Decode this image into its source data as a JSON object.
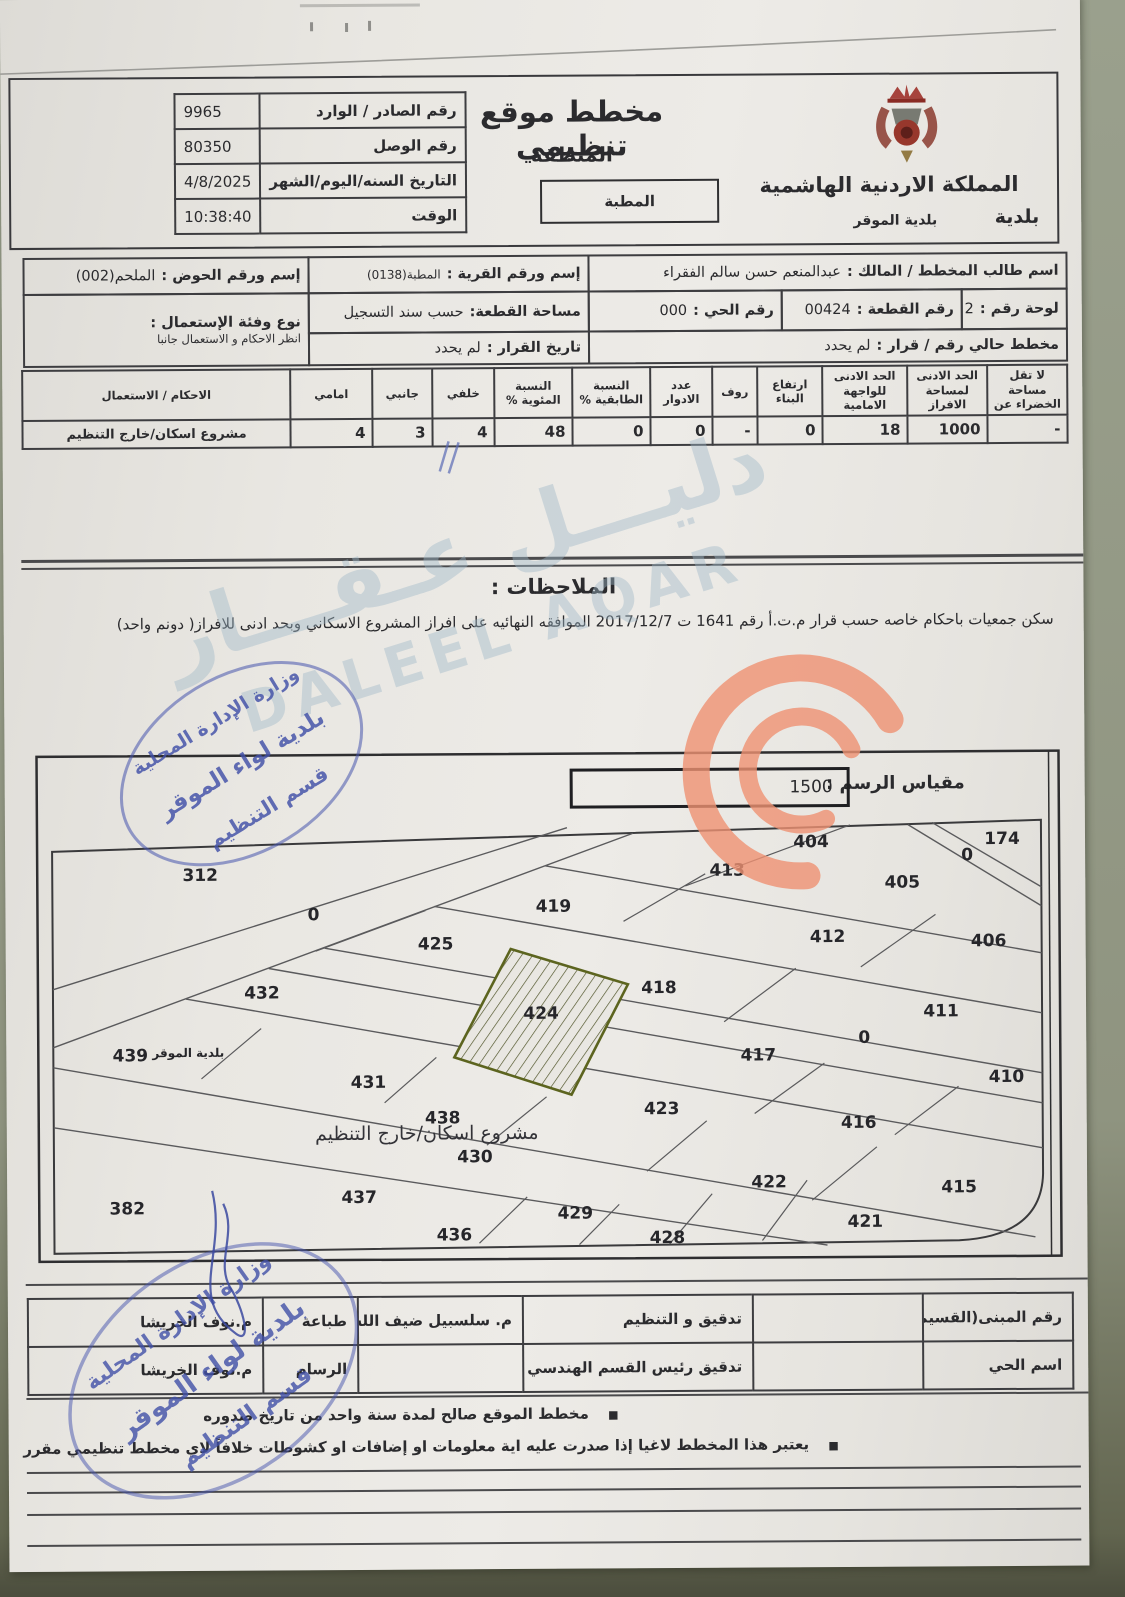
{
  "header": {
    "title": "مخطط موقع تنظيمي",
    "region_label": "المنطقة",
    "region_value": "المطبة",
    "kingdom": "المملكة الاردنية الهاشمية",
    "municipality_word": "بلدية",
    "municipality_name": "بلدية الموقر",
    "ref_rows": [
      {
        "label": "رقم الصادر / الوارد",
        "value": "9965"
      },
      {
        "label": "رقم الوصل",
        "value": "80350"
      },
      {
        "label": "التاريخ السنه/اليوم/الشهر",
        "value": "4/8/2025"
      },
      {
        "label": "الوقت",
        "value": "10:38:40"
      }
    ]
  },
  "info": {
    "owner_label": "اسم طالب المخطط / المالك :",
    "owner_value": "عبدالمنعم حسن سالم الفقراء",
    "village_label": "إسم ورقم القرية :",
    "village_value": "المطبة(0138)",
    "basin_label": "إسم ورقم الحوض :",
    "basin_value": "الملحم(002)",
    "sheet_label": "لوحة رقم :",
    "sheet_value": "2",
    "parcel_label": "رقم القطعة :",
    "parcel_value": "00424",
    "district_label": "رقم الحي :",
    "district_value": "000",
    "area_label": "مساحة القطعة:",
    "area_value": "حسب سند التسجيل",
    "use_label": "نوع وفئة الإستعمال :",
    "use_value": "انظر الاحكام و الاستعمال جانبا",
    "current_plan_label": "مخطط حالي رقم / قرار :",
    "current_plan_value": "لم يحدد",
    "decision_date_label": "تاريخ القرار :",
    "decision_date_value": "لم يحدد"
  },
  "setbacks": {
    "columns": [
      {
        "header": "لا تقل مساحة الخضراء عن",
        "value": "-"
      },
      {
        "header": "الحد الادنى لمساحة الافراز",
        "value": "1000"
      },
      {
        "header": "الحد الادنى للواجهة الامامية",
        "value": "18"
      },
      {
        "header": "ارتفاع البناء",
        "value": "0"
      },
      {
        "header": "روف",
        "value": "-"
      },
      {
        "header": "عدد الادوار",
        "value": "0"
      },
      {
        "header": "النسبة الطابقية %",
        "value": "0"
      },
      {
        "header": "النسبة المئوية %",
        "value": "48"
      },
      {
        "header": "خلفي",
        "value": "4"
      },
      {
        "header": "جانبي",
        "value": "3"
      },
      {
        "header": "امامي",
        "value": "4"
      },
      {
        "header": "الاحكام / الاستعمال",
        "value": "مشروع اسكان/خارج التنظيم"
      }
    ]
  },
  "notes": {
    "heading": "الملاحظات :",
    "text": "سكن جمعيات باحكام خاصه حسب قرار م.ت.أ رقم 1641 ت 2017/12/7 الموافقه النهائيه على افراز المشروع الاسكاني وبحد ادنى للافراز( دونم واحد)"
  },
  "map": {
    "scale_label": "مقياس الرسم :",
    "scale_value": "1500",
    "project_text": "مشروع اسكان/خارج التنظيم",
    "subject_plot": "424",
    "plots": [
      {
        "label": "312",
        "x": 195,
        "y": 882
      },
      {
        "label": "0",
        "x": 308,
        "y": 922
      },
      {
        "label": "404",
        "x": 806,
        "y": 852
      },
      {
        "label": "174",
        "x": 997,
        "y": 850
      },
      {
        "label": "0",
        "x": 962,
        "y": 866
      },
      {
        "label": "413",
        "x": 722,
        "y": 880
      },
      {
        "label": "405",
        "x": 897,
        "y": 893
      },
      {
        "label": "419",
        "x": 548,
        "y": 915
      },
      {
        "label": "412",
        "x": 822,
        "y": 947
      },
      {
        "label": "406",
        "x": 983,
        "y": 952
      },
      {
        "label": "425",
        "x": 430,
        "y": 952
      },
      {
        "label": "418",
        "x": 653,
        "y": 997
      },
      {
        "label": "411",
        "x": 935,
        "y": 1022
      },
      {
        "label": "432",
        "x": 256,
        "y": 1000
      },
      {
        "label": "424",
        "x": 535,
        "y": 1022
      },
      {
        "label": "0",
        "x": 858,
        "y": 1048
      },
      {
        "label": "417",
        "x": 752,
        "y": 1065
      },
      {
        "label": "410",
        "x": 1000,
        "y": 1088
      },
      {
        "label": "439",
        "x": 124,
        "y": 1062
      },
      {
        "label": "بلدية الموقر",
        "x": 182,
        "y": 1058,
        "small": true
      },
      {
        "label": "431",
        "x": 362,
        "y": 1090
      },
      {
        "label": "423",
        "x": 655,
        "y": 1118
      },
      {
        "label": "438",
        "x": 436,
        "y": 1126
      },
      {
        "label": "416",
        "x": 852,
        "y": 1133
      },
      {
        "label": "430",
        "x": 468,
        "y": 1165
      },
      {
        "label": "422",
        "x": 762,
        "y": 1192
      },
      {
        "label": "415",
        "x": 952,
        "y": 1198
      },
      {
        "label": "437",
        "x": 352,
        "y": 1205
      },
      {
        "label": "382",
        "x": 120,
        "y": 1215
      },
      {
        "label": "429",
        "x": 568,
        "y": 1222
      },
      {
        "label": "421",
        "x": 858,
        "y": 1232
      },
      {
        "label": "436",
        "x": 447,
        "y": 1243
      },
      {
        "label": "428",
        "x": 660,
        "y": 1247
      }
    ]
  },
  "signature_table": {
    "rows": [
      [
        "رقم المبنى(القسيمة)",
        "",
        "تدقيق و التنظيم",
        "م. سلسبيل ضيف الله",
        "طباعة",
        "م.نوف الخريشا"
      ],
      [
        "اسم الحي",
        "",
        "تدقيق رئيس القسم الهندسي",
        "",
        "الرسام",
        "م.نوف الخريشا"
      ]
    ]
  },
  "footer_bullets": [
    "مخطط الموقع صالح لمدة سنة واحد من تاريخ صدوره",
    "يعتبر هذا المخطط لاغيا إذا صدرت عليه اية معلومات او إضافات او كشوطات خلافاً لاي مخطط تنظيمي مقرر"
  ],
  "stamp": {
    "line1": "وزارة الإدارة المحلية",
    "line2": "بلدية لواء الموقر",
    "line3": "قسم التنظيم"
  },
  "watermark": {
    "arabic": "دليـــل عـقـــار",
    "latin": "DALEEL AQAR"
  },
  "colors": {
    "stamp_blue": "#4553ad",
    "watermark_blue": "#9fb8c8",
    "logo_orange": "#ef9273",
    "subject_plot_olive": "#5c641f"
  }
}
